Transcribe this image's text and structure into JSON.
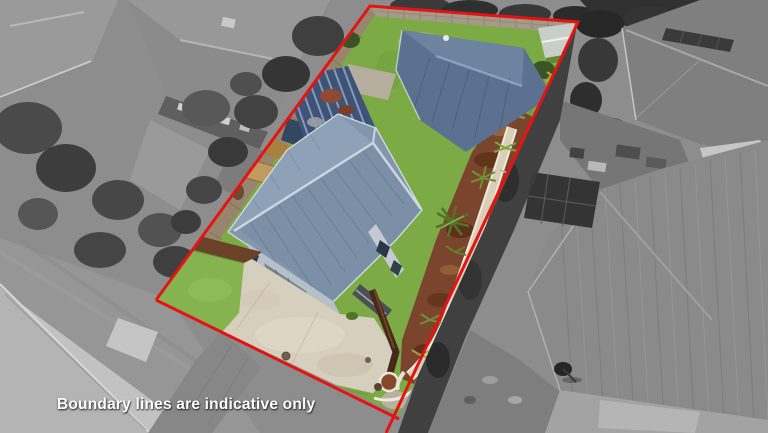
{
  "photo": {
    "caption": "Boundary lines are indicative only"
  },
  "colors": {
    "boundary_line": "#e41414",
    "caption_text": "#ffffff",
    "lawn_green": "#7cab46",
    "roof_blue_grey": "#8396ad",
    "driveway_concrete": "#d6cfbd",
    "garden_mulch": "#7a452c",
    "greyscale_surroundings": "#8d8d8d"
  }
}
